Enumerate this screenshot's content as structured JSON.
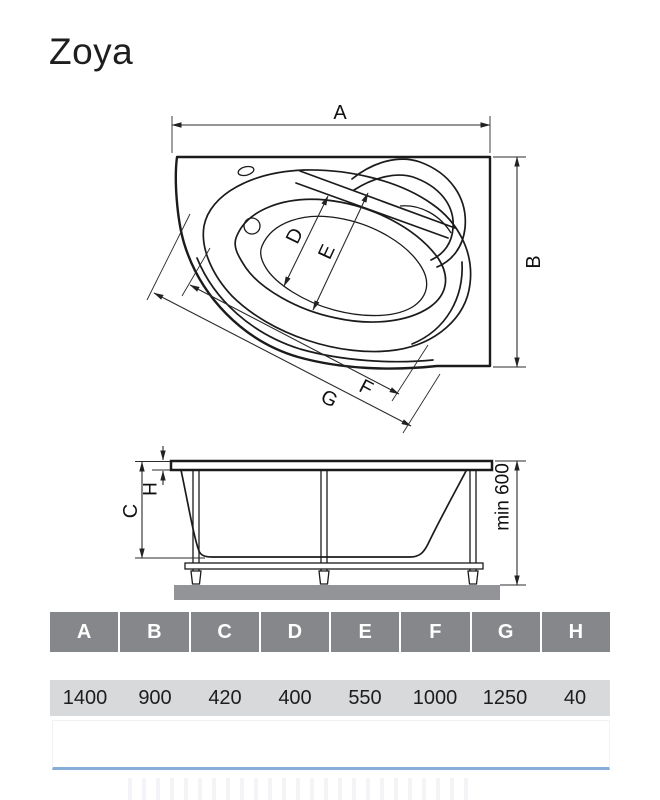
{
  "title": "Zoya",
  "top_view": {
    "dim_labels": {
      "a": "A",
      "b": "B",
      "d": "D",
      "e": "E",
      "f": "F",
      "g": "G"
    }
  },
  "side_view": {
    "dim_labels": {
      "c": "C",
      "h": "H",
      "min_height": "min 600"
    }
  },
  "dimensions_table": {
    "headers": [
      "A",
      "B",
      "C",
      "D",
      "E",
      "F",
      "G",
      "H"
    ],
    "values_mm": [
      "1400",
      "900",
      "420",
      "400",
      "550",
      "1000",
      "1250",
      "40"
    ]
  },
  "colors": {
    "drawing_line": "#1b1b1b",
    "table_header_bg": "#85878a",
    "table_header_text": "#ffffff",
    "table_row_bg": "#d8d9db",
    "accent_line": "#86add8",
    "ground_fill": "#929497"
  }
}
